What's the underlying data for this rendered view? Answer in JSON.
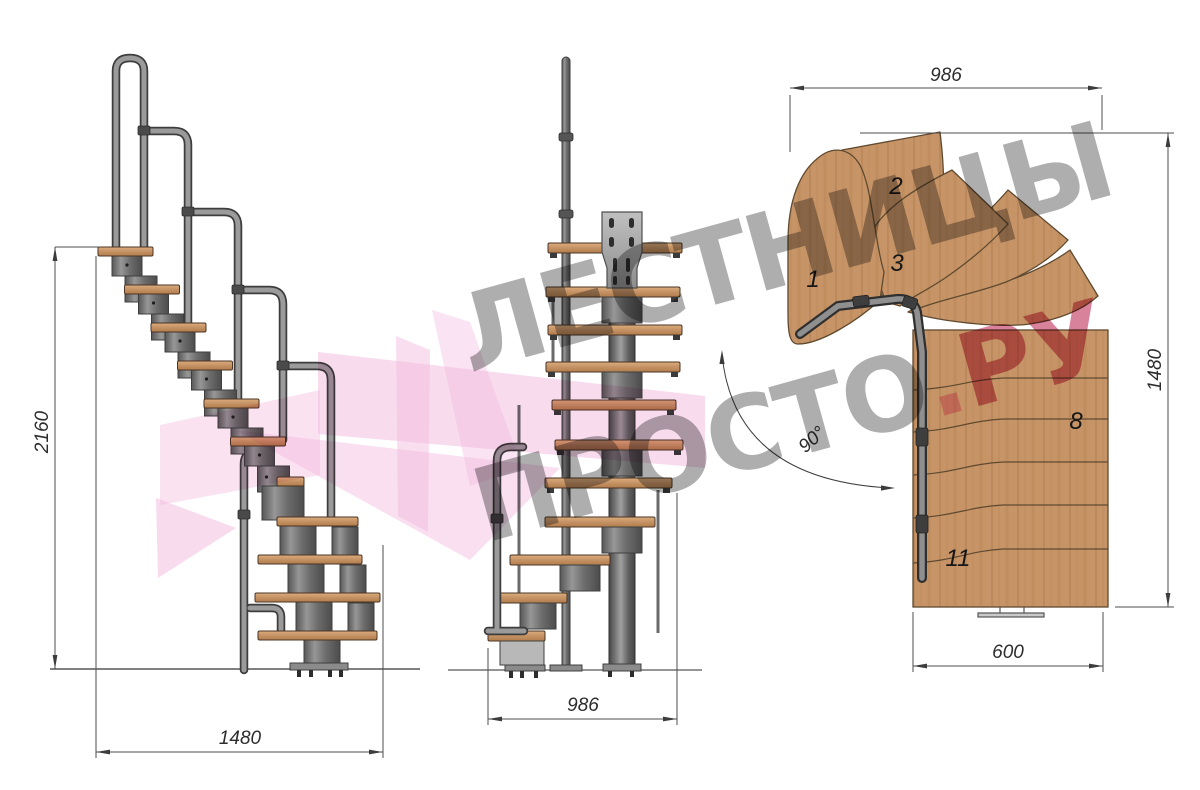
{
  "watermark": {
    "line1": "ЛЕСТНИЦЫ",
    "line2_gray": "ПРОСТО",
    "line2_dot": ".",
    "line2_pink": "РУ"
  },
  "views": {
    "side": {
      "label": "side-elevation",
      "height_mm": "2160",
      "width_mm": "1480"
    },
    "front": {
      "label": "front-elevation",
      "width_mm": "986"
    },
    "plan": {
      "label": "top-plan",
      "width_mm": "986",
      "length_mm": "1480",
      "exit_width_mm": "600",
      "turn_angle": "90°",
      "tread_numbers": {
        "t1": "1",
        "t2": "2",
        "t3": "3",
        "t8": "8",
        "t11": "11"
      }
    }
  },
  "colors": {
    "wood": "#c79467",
    "metal": "#6d6d6d",
    "handrail": "#979797",
    "dimension": "#3c3c3c",
    "watermark_gray": "#979797",
    "watermark_pink": "#f2b9de",
    "watermark_accent": "#cf5f80"
  }
}
